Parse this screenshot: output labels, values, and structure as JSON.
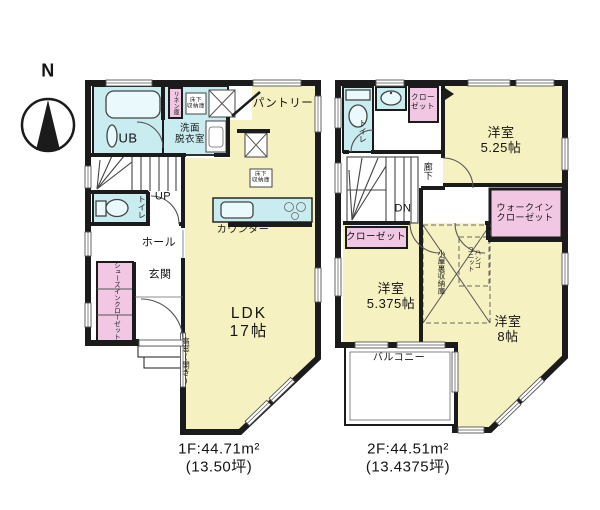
{
  "compass": {
    "north_label": "N"
  },
  "colors": {
    "room_yellow": "#F5F1C0",
    "wet_cyan": "#C8ECEF",
    "closet_pink": "#F1C7E4",
    "wall": "#1B1B1B"
  },
  "floor1": {
    "title_area": "1F:44.71m²",
    "title_tsubo": "(13.50坪)",
    "labels": {
      "unit_bath": "UB",
      "washroom": "洗面\n脱衣室",
      "linen_closet": "リネン庫",
      "underfloor_storage_top": "床下\n収納庫",
      "pantry": "パントリー",
      "underfloor_storage_ldk": "床下\n収納庫",
      "kitchen_counter": "カウンター",
      "stairs_up": "UP",
      "toilet": "トイレ",
      "hall": "ホール",
      "entrance": "玄関",
      "shoes_in_closet": "シューズインクローゼット",
      "ldk": "LDK\n17帖",
      "high_window": "高窓(開き)"
    }
  },
  "floor2": {
    "title_area": "2F:44.51m²",
    "title_tsubo": "(13.4375坪)",
    "labels": {
      "toilet": "トイレ",
      "closet_north": "クロー\nゼット",
      "western_room_525": "洋室\n5.25帖",
      "corridor": "廊下",
      "stairs_down": "DN",
      "walk_in_closet": "ウォークイン\nクローゼット",
      "closet_west": "クローゼット",
      "western_room_5375": "洋室\n5.375帖",
      "attic_storage": "小屋裏収納庫",
      "ladder_unit": "ハシゴ\nユニット",
      "western_room_8": "洋室\n8帖",
      "balcony": "バルコニー"
    }
  }
}
